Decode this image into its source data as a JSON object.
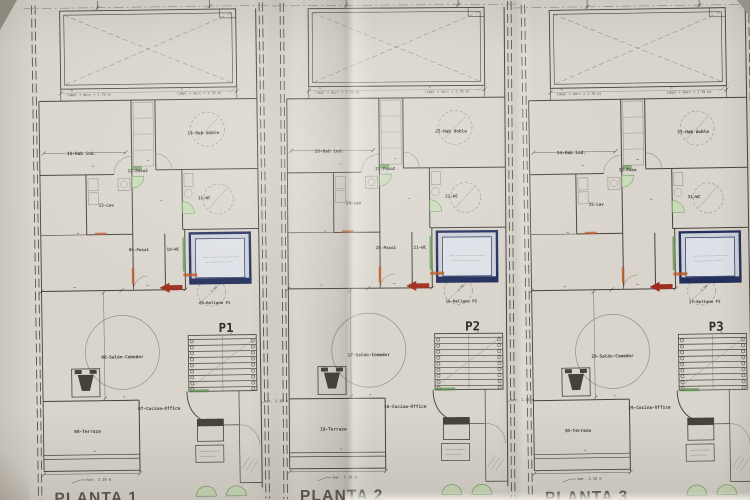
{
  "colors": {
    "paper": "#d9d5cd",
    "line": "#45423c",
    "line_soft": "#8a867d",
    "green": "#5f8f52",
    "green_fill": "#c8dcb6",
    "orange": "#c05a28",
    "red": "#9e2f1e",
    "navy": "#232f5c",
    "navy_fill": "#ccd1da",
    "title_gray": "#57544d"
  },
  "annotations": {
    "ampl": "(ampl + marc = 1.70 m)",
    "bar": "bar. 1.10 m",
    "turning_radius": "1.50"
  },
  "plans": [
    {
      "id": "P1",
      "title": "PLANTA 1",
      "level_label": "P1",
      "labels": {
        "hab_ind": "15-Hab ind.",
        "hab_doble": "14-Hab doble",
        "paso2": "12-Paso2",
        "lav": "13-Lav",
        "wc_upper": "11-WC",
        "paso1": "09-Paso1",
        "wc_lower": "10-WC",
        "rellano": "05-Rellano P1",
        "salon": "06-Salón-Comedor",
        "cocina": "07-Cocina-Office",
        "terraza": "08-Terraza"
      }
    },
    {
      "id": "P2",
      "title": "PLANTA 2",
      "level_label": "P2",
      "labels": {
        "hab_ind": "26-Hab ind.",
        "hab_doble": "25-Hab doble",
        "paso2": "23-Paso2",
        "lav": "24-Lav",
        "wc_upper": "22-WC",
        "paso1": "20-Paso1",
        "wc_lower": "21-WC",
        "rellano": "16-Rellano P2",
        "salon": "17-Salón-Comedor",
        "cocina": "18-Cocina-Office",
        "terraza": "19-Terraza"
      }
    },
    {
      "id": "P3",
      "title": "PLANTA 3",
      "level_label": "P3",
      "labels": {
        "hab_ind": "34-Hab ind.",
        "hab_doble": "33-Hab doble",
        "paso2": "32-Paso",
        "lav": "35-Lav",
        "wc_upper": "31-WC",
        "paso1": null,
        "wc_lower": null,
        "rellano": "27-Rellano P3",
        "salon": "28-Salón-Comedor",
        "cocina": "29-Cocina-Office",
        "terraza": "30-Terraza"
      }
    }
  ]
}
